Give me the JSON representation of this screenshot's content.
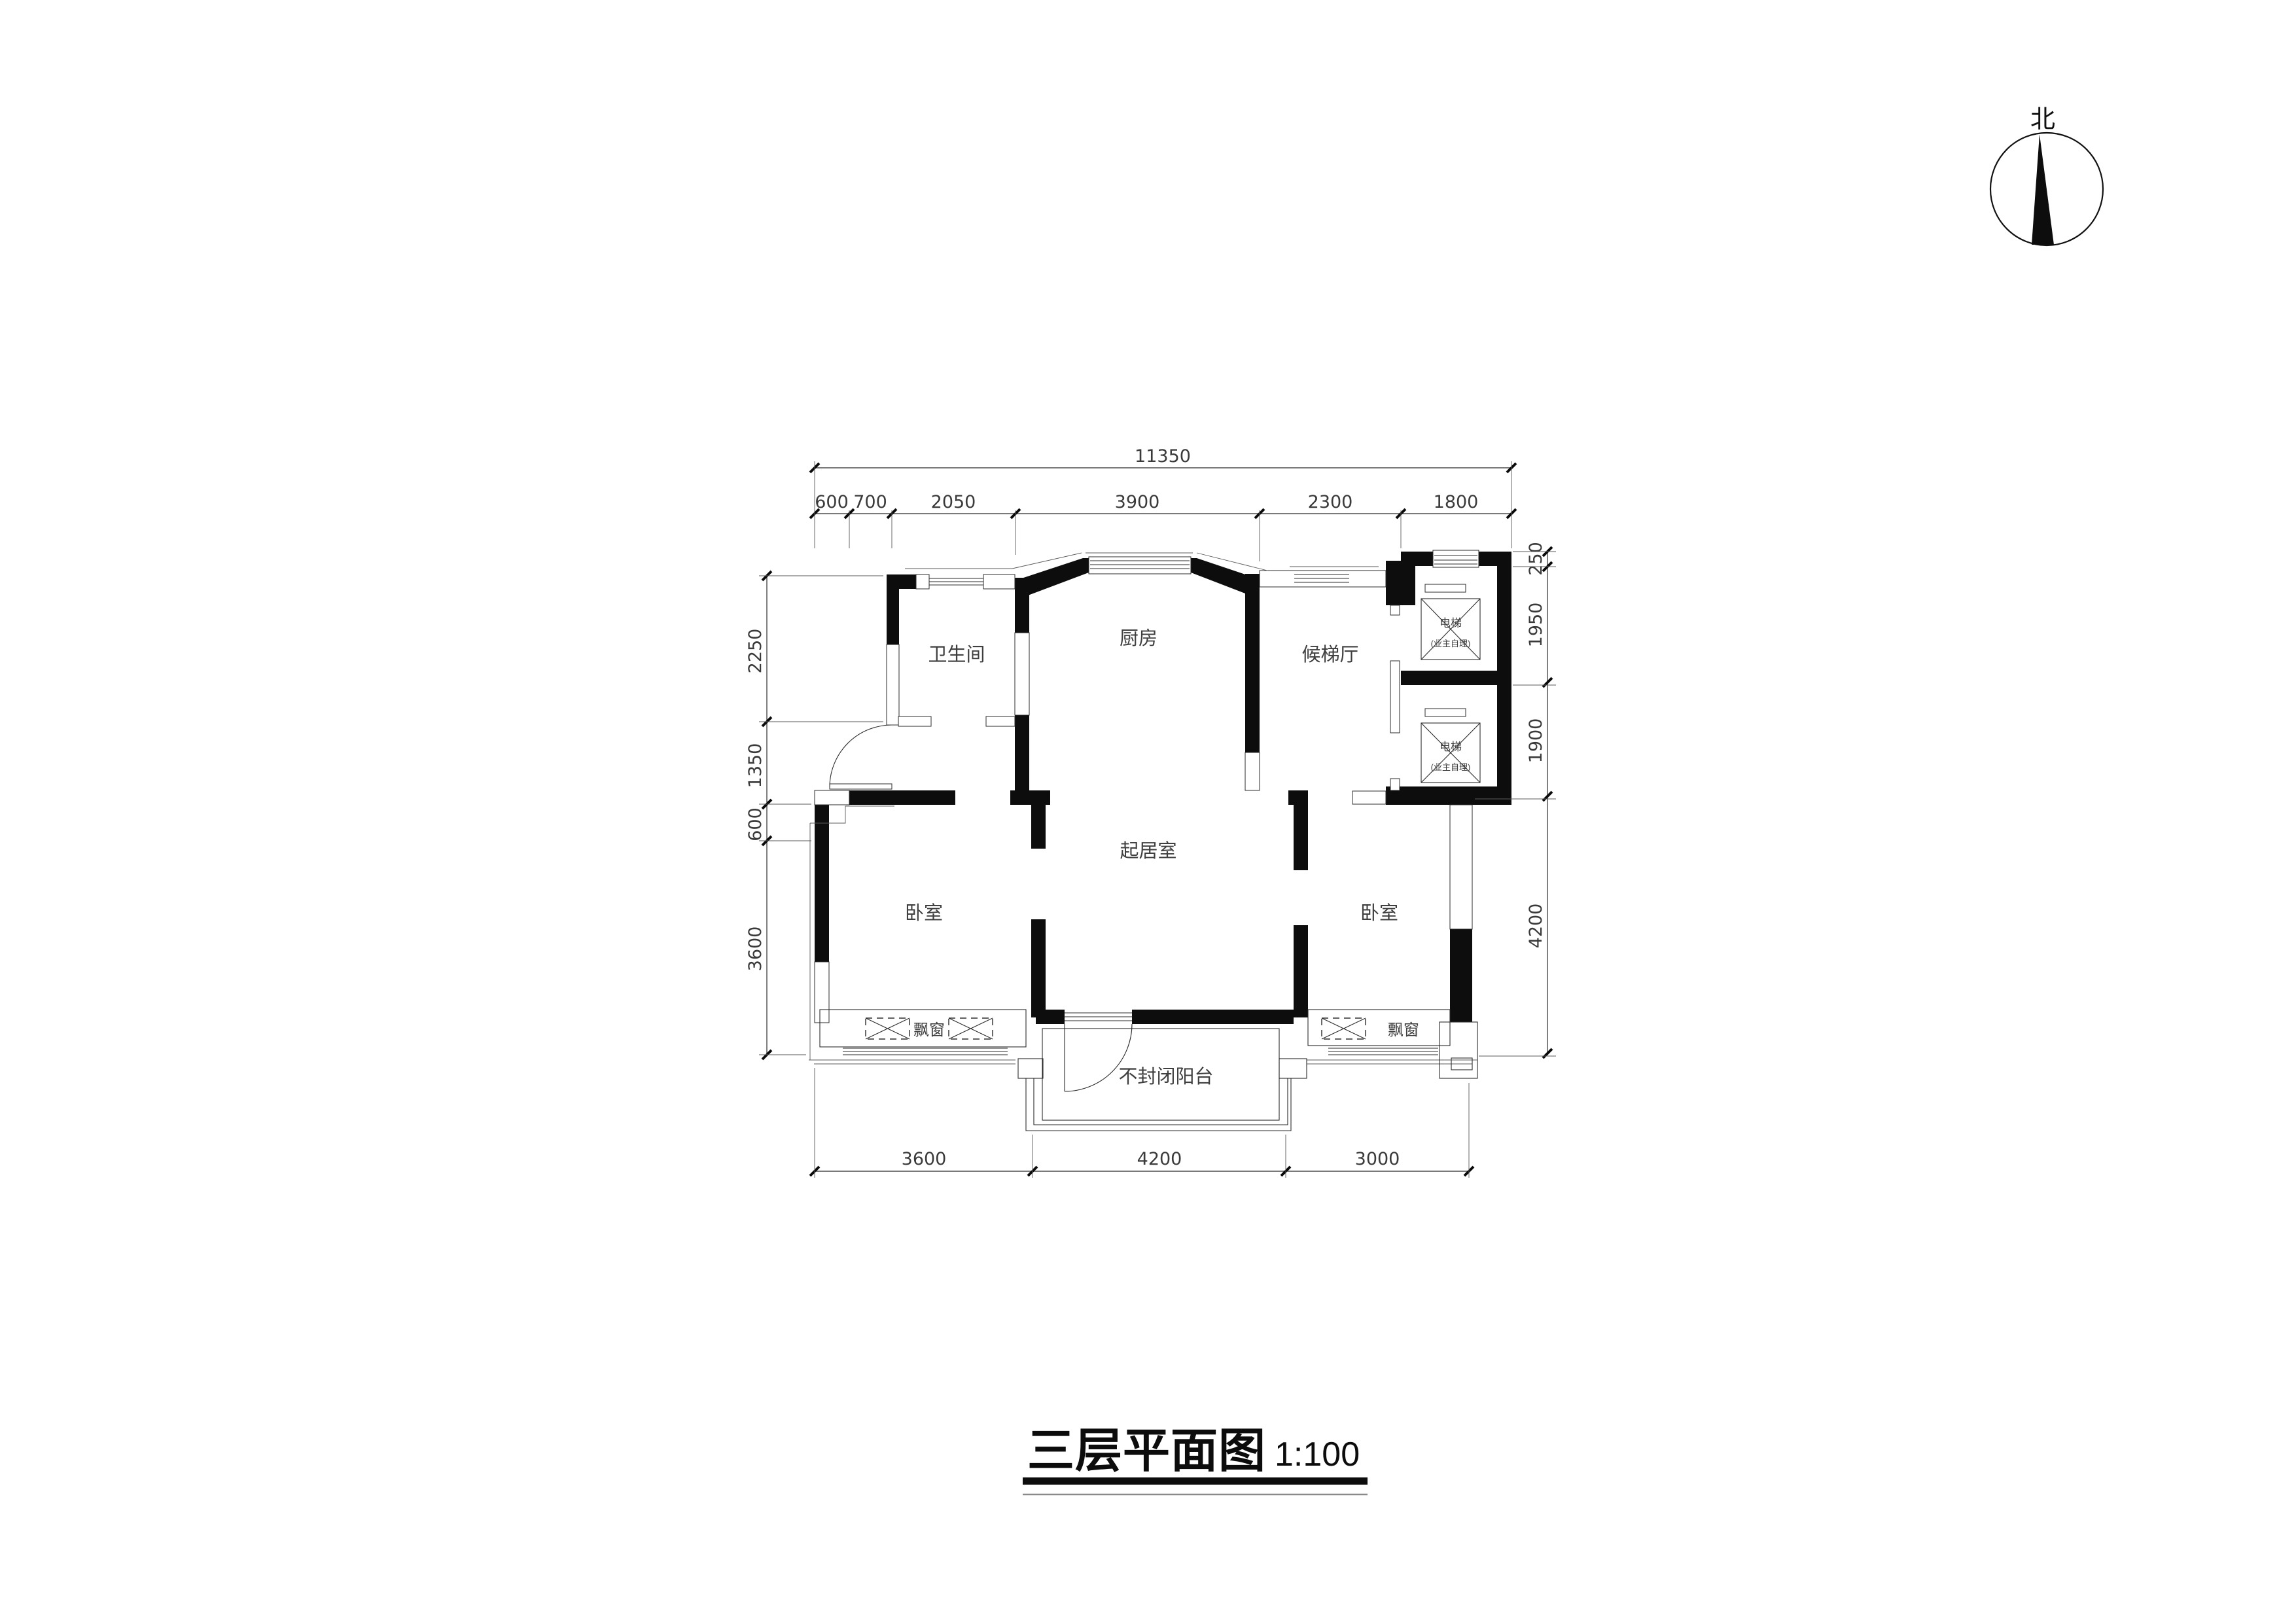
{
  "title": {
    "text": "三层平面图",
    "scale": "1:100"
  },
  "compass": {
    "north_label": "北"
  },
  "rooms": {
    "kitchen": "厨房",
    "bathroom": "卫生间",
    "elevator_hall": "候梯厅",
    "living_room": "起居室",
    "bedroom": "卧室",
    "balcony": "不封闭阳台",
    "bay_window": "飘窗"
  },
  "elevator": {
    "label": "电梯",
    "note": "(业主自理)"
  },
  "dimensions": {
    "top_total": "11350",
    "top_segments": [
      "600",
      "700",
      "2050",
      "3900",
      "2300",
      "1800"
    ],
    "left_segments": [
      "2250",
      "1350",
      "600",
      "3600"
    ],
    "right_segments": [
      "250",
      "1950",
      "1900",
      "4200"
    ],
    "bottom_segments": [
      "3600",
      "4200",
      "3000"
    ]
  },
  "colors": {
    "wall": "#0d0d0d",
    "line": "#2b2b2b",
    "text": "#3a3a3a"
  }
}
